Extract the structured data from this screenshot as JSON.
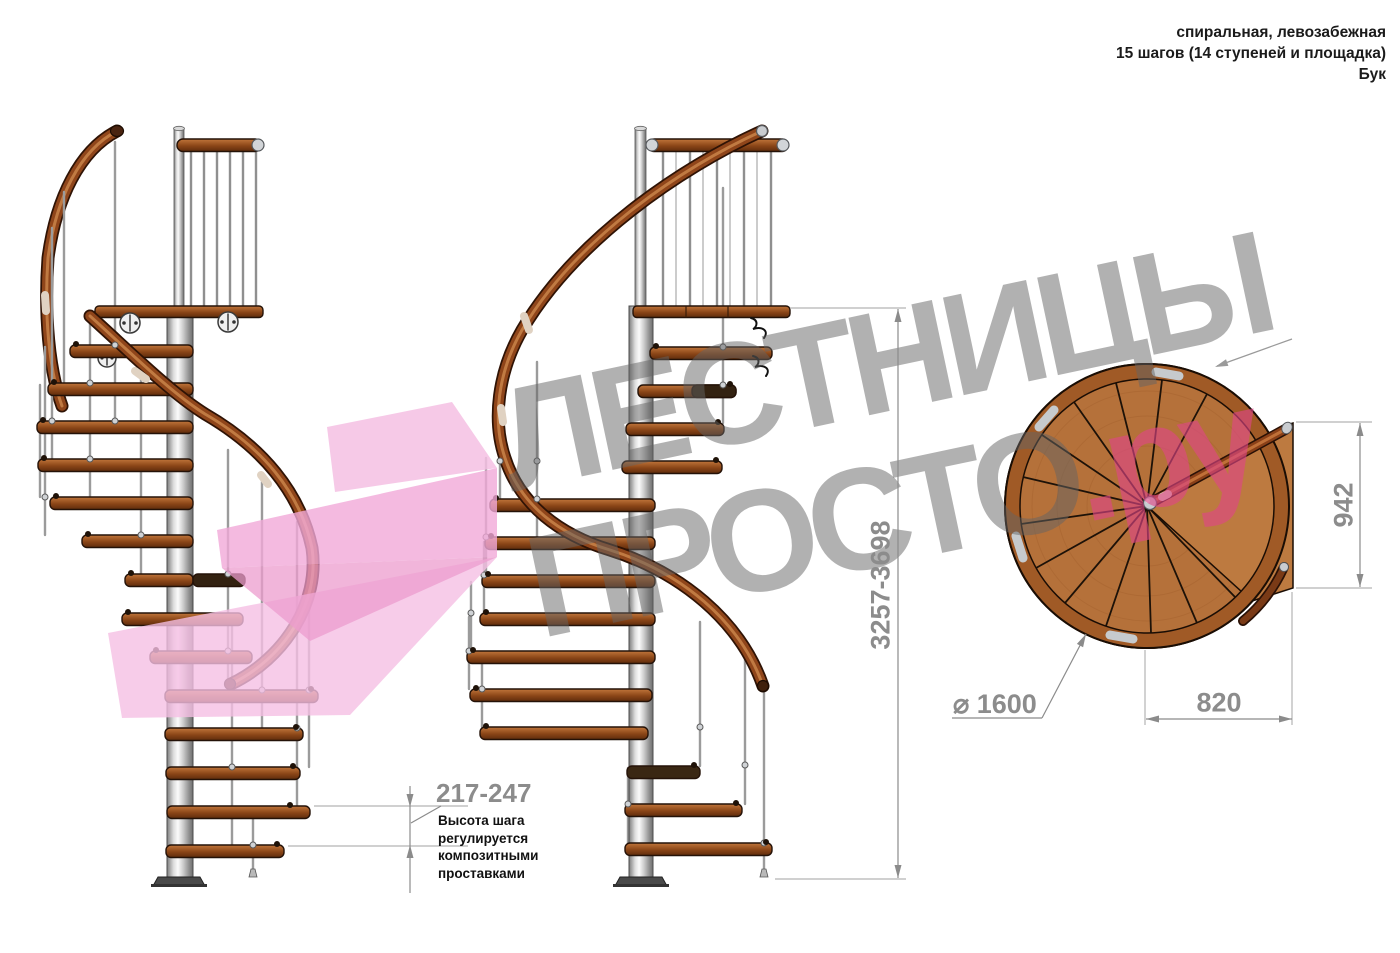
{
  "header": {
    "line1": "спиральная, левозабежная",
    "line2": "15 шагов (14 ступеней и площадка)",
    "line3": "Бук"
  },
  "watermark": {
    "line1": "ЛЕСТНИЦЫ",
    "line2": "ПРОСТО",
    "suffix": ".ру"
  },
  "dimensions": {
    "total_height": "3257-3698",
    "landing_depth": "942",
    "landing_width": "820",
    "diameter": "⌀ 1600",
    "step_height": "217-247",
    "step_height_note": "Высота шага\nрегулируется\nкомпозитными\nпроставками"
  },
  "colors": {
    "wood": "#a25a28",
    "metal": "#c9c9c9",
    "dimension_gray": "#8b8b8b",
    "watermark_gray": "#9a9a9a",
    "accent_pink": "#f1a9d8"
  }
}
